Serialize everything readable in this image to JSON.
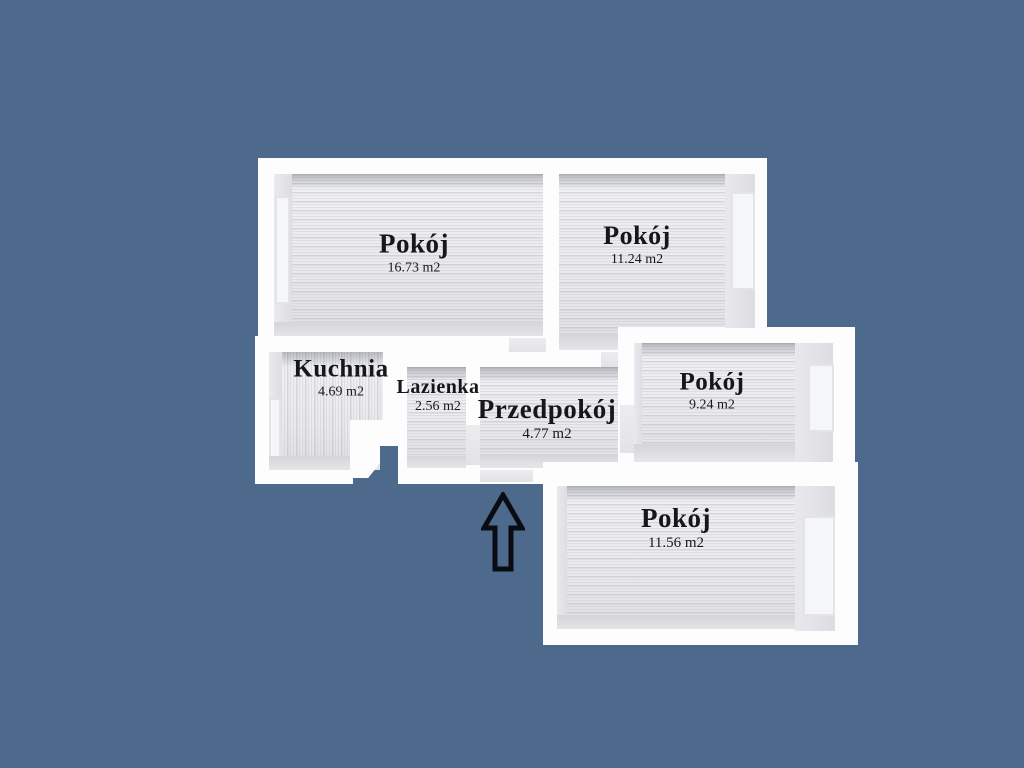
{
  "background_color": "#4d6a8c",
  "wall_color": "#fdfdfe",
  "text_color": "#17171b",
  "rooms": [
    {
      "name": "Pokój",
      "area": "16.73 m2"
    },
    {
      "name": "Pokój",
      "area": "11.24 m2"
    },
    {
      "name": "Kuchnia",
      "area": "4.69 m2"
    },
    {
      "name": "Lazienka",
      "area": "2.56 m2"
    },
    {
      "name": "Przedpokój",
      "area": "4.77 m2"
    },
    {
      "name": "Pokój",
      "area": "9.24 m2"
    },
    {
      "name": "Pokój",
      "area": "11.56 m2"
    }
  ],
  "entrance": {
    "icon": "up-arrow-icon"
  }
}
